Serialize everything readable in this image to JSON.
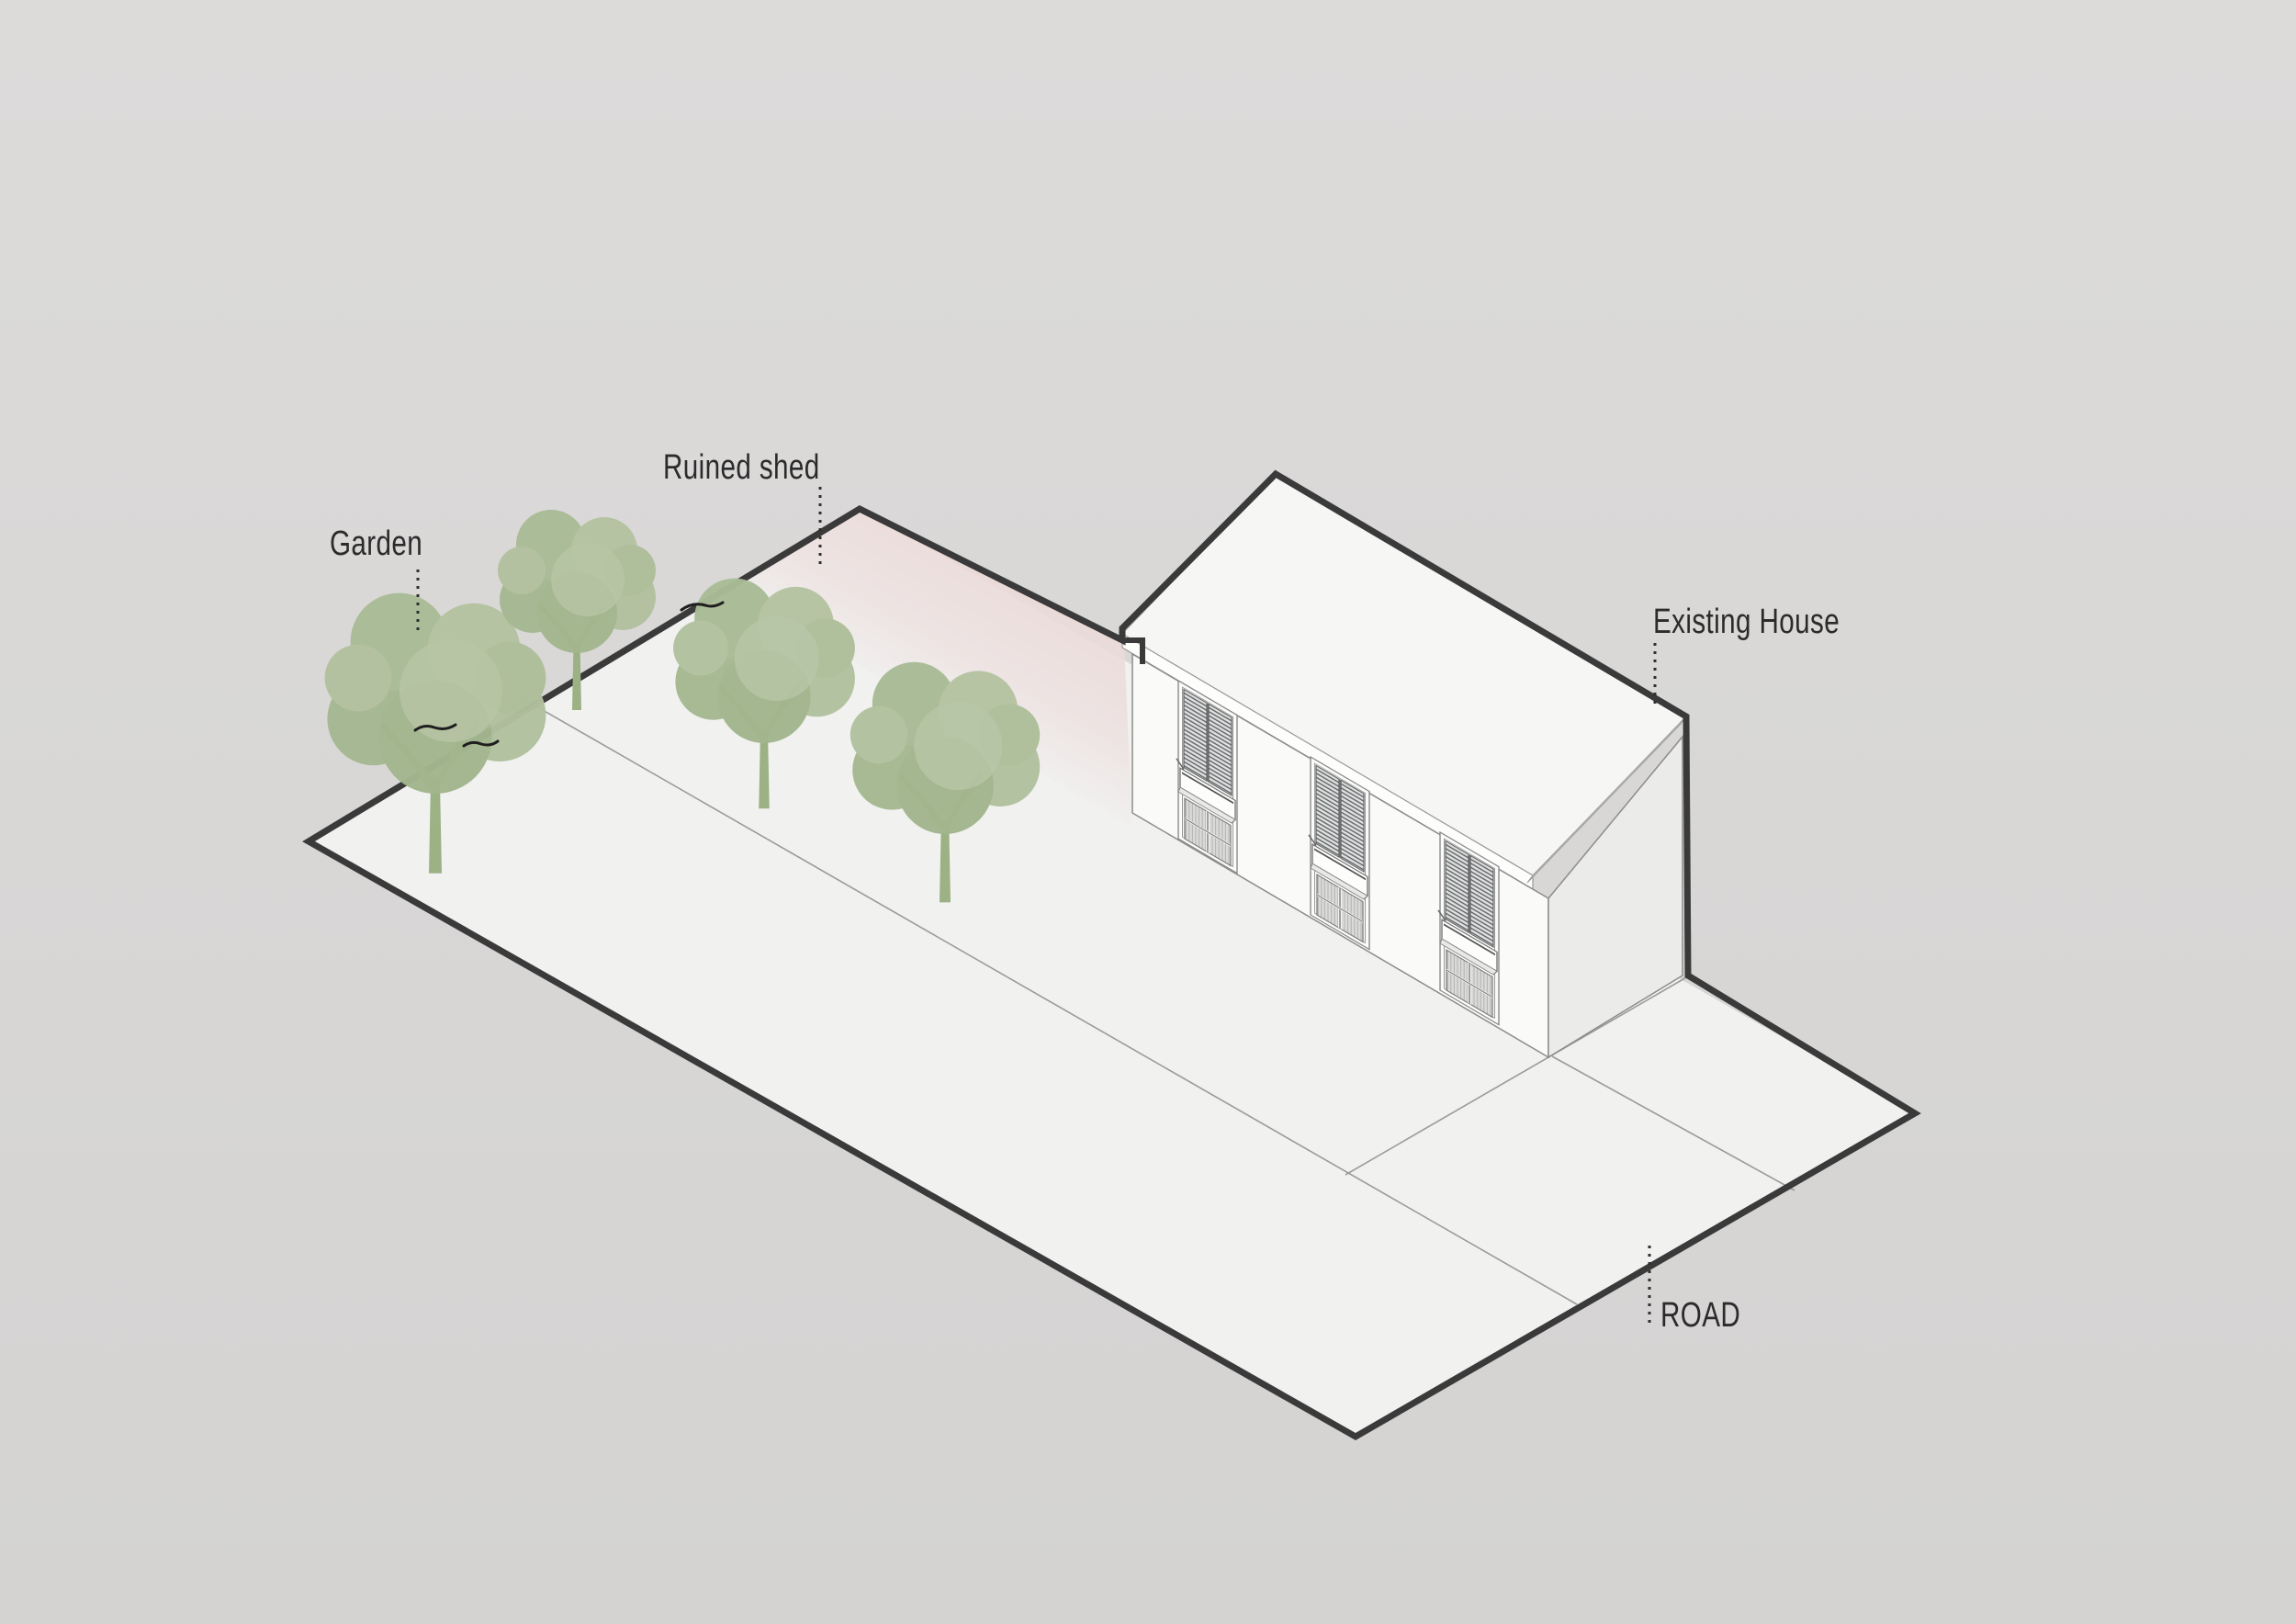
{
  "diagram": {
    "kind": "axonometric-site-diagram",
    "labels": {
      "garden": "Garden",
      "ruined_shed": "Ruined shed",
      "existing_house": "Existing House",
      "road": "ROAD"
    },
    "colors": {
      "background": "#d9d8d7",
      "site_ground": "#f1f1f0",
      "boundary_line": "#3a3a3a",
      "ruined_shed_tint": "#ebdbda",
      "tree_canopy": "#aebf9b",
      "tree_trunk": "#9cb184",
      "house_wall": "#fafaf9",
      "house_roof": "#f6f6f5",
      "label_text": "#2b2b2b"
    },
    "elements": {
      "tree_count": 4,
      "facade_window_count": 3
    }
  }
}
